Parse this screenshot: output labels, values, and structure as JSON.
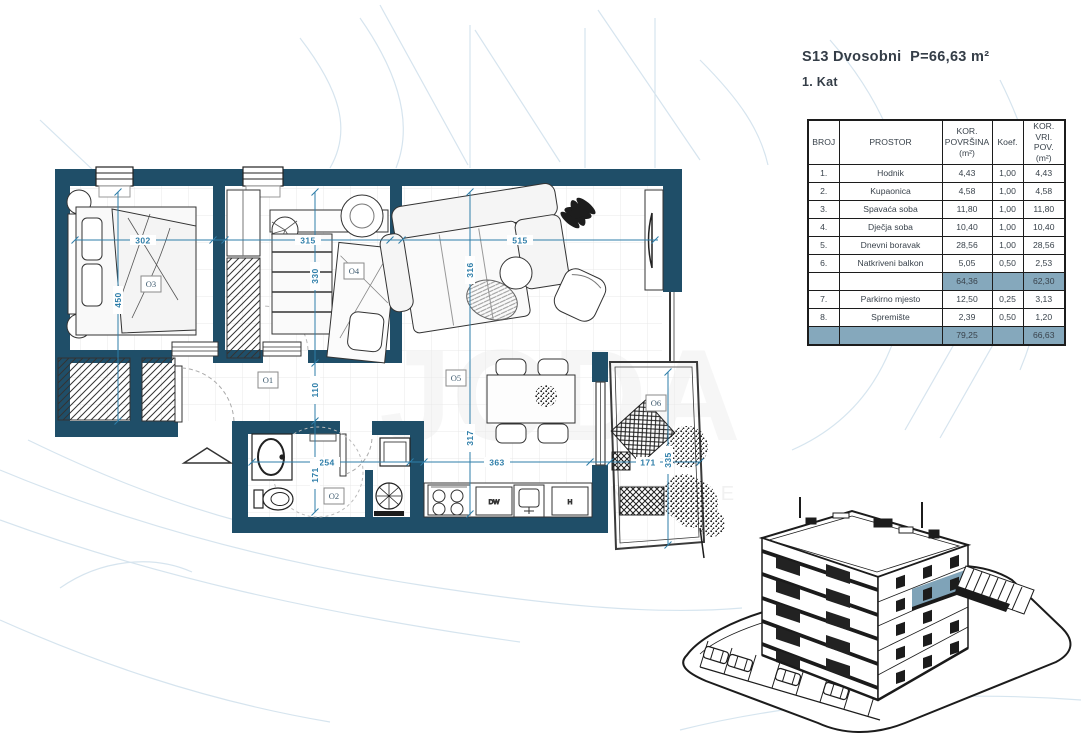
{
  "header": {
    "title": "S13 Dvosobni  P=66,63 m²",
    "floor": "1. Kat"
  },
  "table": {
    "headers": {
      "broj": "BROJ",
      "prostor": "PROSTOR",
      "kor_povrsina": "KOR.\nPOVRŠINA\n(m²)",
      "koef": "Koef.",
      "kor_vri_pov": "KOR. VRI.\nPOV.\n(m²)"
    },
    "rows": [
      {
        "broj": "1.",
        "prostor": "Hodnik",
        "povrsina": "4,43",
        "koef": "1,00",
        "vri_pov": "4,43"
      },
      {
        "broj": "2.",
        "prostor": "Kupaonica",
        "povrsina": "4,58",
        "koef": "1,00",
        "vri_pov": "4,58"
      },
      {
        "broj": "3.",
        "prostor": "Spavaća soba",
        "povrsina": "11,80",
        "koef": "1,00",
        "vri_pov": "11,80"
      },
      {
        "broj": "4.",
        "prostor": "Dječja soba",
        "povrsina": "10,40",
        "koef": "1,00",
        "vri_pov": "10,40"
      },
      {
        "broj": "5.",
        "prostor": "Dnevni boravak",
        "povrsina": "28,56",
        "koef": "1,00",
        "vri_pov": "28,56"
      },
      {
        "broj": "6.",
        "prostor": "Natkriveni balkon",
        "povrsina": "5,05",
        "koef": "0,50",
        "vri_pov": "2,53"
      }
    ],
    "subtotal": {
      "povrsina": "64,36",
      "vri_pov": "62,30"
    },
    "rows_extra": [
      {
        "broj": "7.",
        "prostor": "Parkirno mjesto",
        "povrsina": "12,50",
        "koef": "0,25",
        "vri_pov": "3,13"
      },
      {
        "broj": "8.",
        "prostor": "Spremište",
        "povrsina": "2,39",
        "koef": "0,50",
        "vri_pov": "1,20"
      }
    ],
    "total": {
      "povrsina": "79,25",
      "vri_pov": "66,63"
    }
  },
  "plan": {
    "room_labels": {
      "o1": "O1",
      "o2": "O2",
      "o3": "O3",
      "o4": "O4",
      "o5": "O5",
      "o6": "O6"
    },
    "dimensions": {
      "d302": "302",
      "d315": "315",
      "d515": "515",
      "d254": "254",
      "d363": "363",
      "d171_balc": "171",
      "d450": "450",
      "d330": "330",
      "d110": "110",
      "d171_bath": "171",
      "d316": "316",
      "d317": "317",
      "d335": "335"
    },
    "kitchen_labels": {
      "dw": "DW",
      "h": "H"
    }
  },
  "watermark": {
    "line1": "JODA",
    "line2": "N E K R E T N I N E"
  },
  "colors": {
    "wall": "#1f4e68",
    "dimension": "#2e7ea9",
    "table_highlight": "#85a8bc",
    "unit_highlight": "#7fa3b8",
    "background_lines": "#cfe0ec",
    "text": "#39424b"
  }
}
